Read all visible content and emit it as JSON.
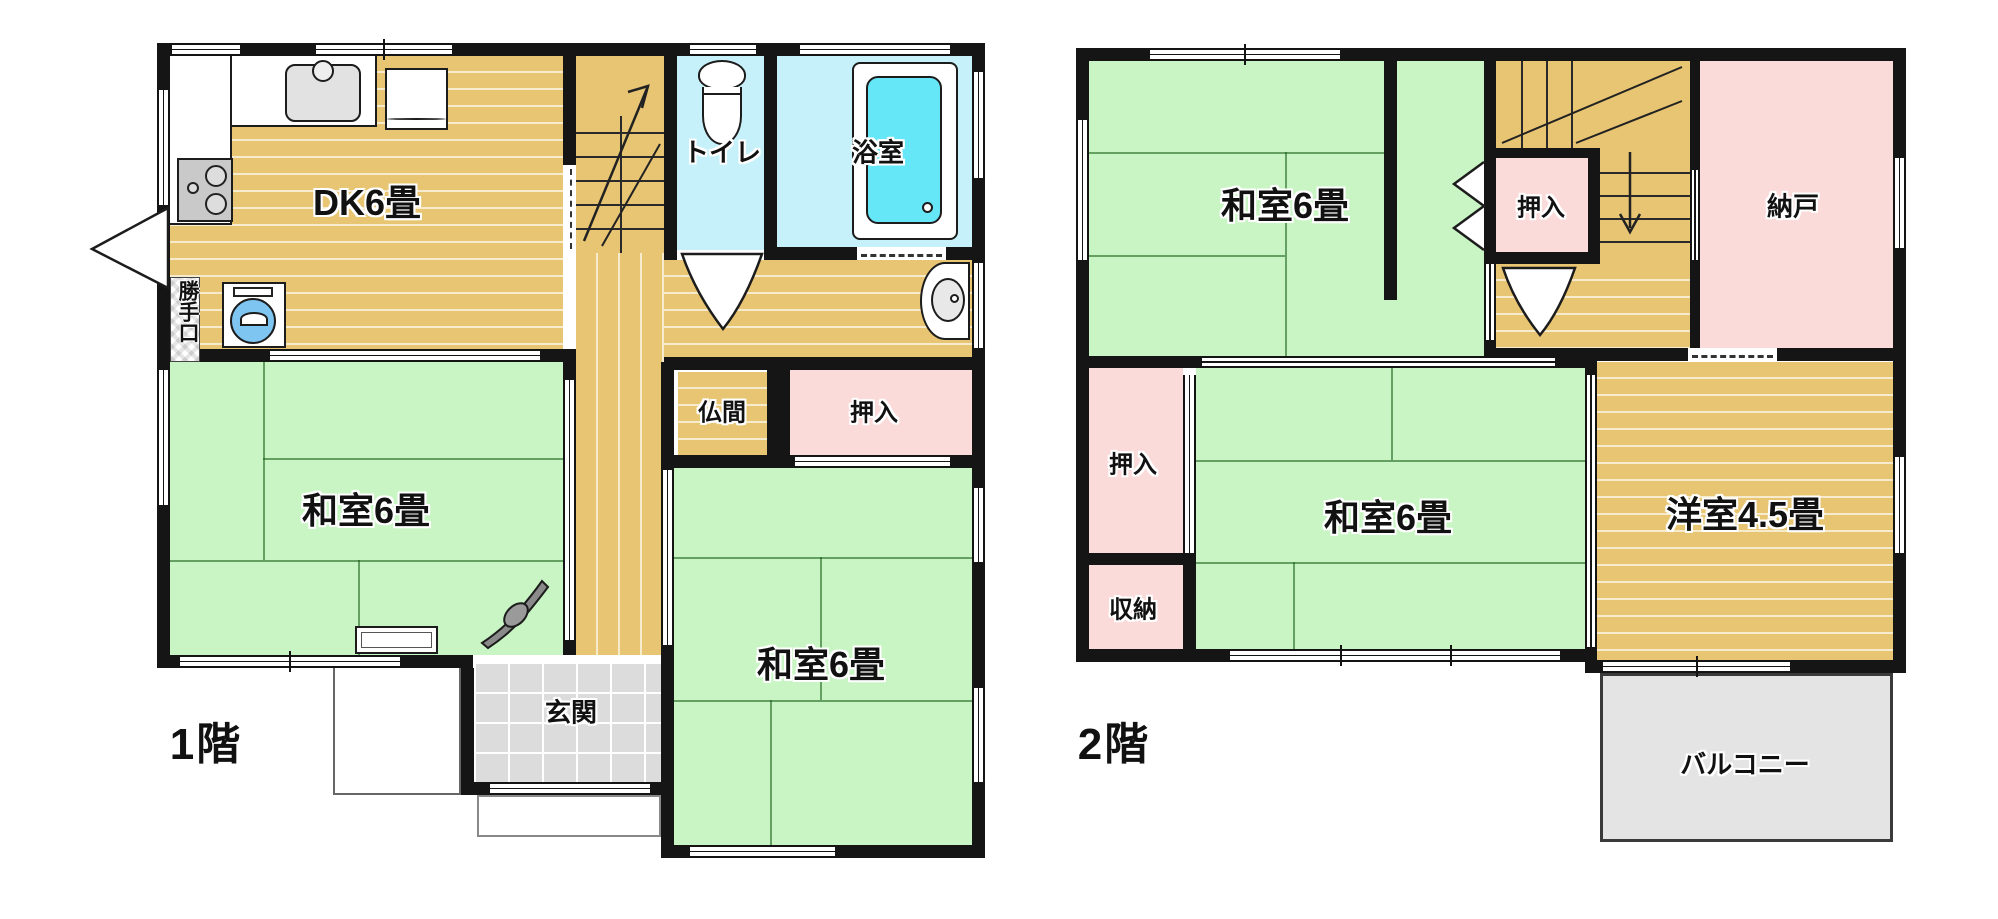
{
  "plan": {
    "floor1": {
      "floor_label": "1階",
      "rooms": {
        "dk": "DK6畳",
        "katteguchi": "勝手口",
        "toilet": "トイレ",
        "bath": "浴室",
        "butsuma": "仏間",
        "oshiire": "押入",
        "washitsu_left": "和室6畳",
        "washitsu_right": "和室6畳",
        "genkan": "玄関"
      }
    },
    "floor2": {
      "floor_label": "2階",
      "rooms": {
        "washitsu_top": "和室6畳",
        "oshiire_top": "押入",
        "nando": "納戸",
        "oshiire_mid": "押入",
        "washitsu_mid": "和室6畳",
        "youshitsu": "洋室4.5畳",
        "shuunou": "収納",
        "balcony": "バルコニー"
      }
    },
    "colors": {
      "wood_floor": "#e8c572",
      "tatami_green": "#c8f5c3",
      "water_cyan": "#c7f1fa",
      "bathtub_cyan": "#66e7f7",
      "closet_pink": "#fbdada",
      "entry_tile_gray": "#dcdcdc",
      "balcony_gray": "#e4e4e4",
      "wall_black": "#151515",
      "washer_blue": "#7ec5f2"
    }
  }
}
